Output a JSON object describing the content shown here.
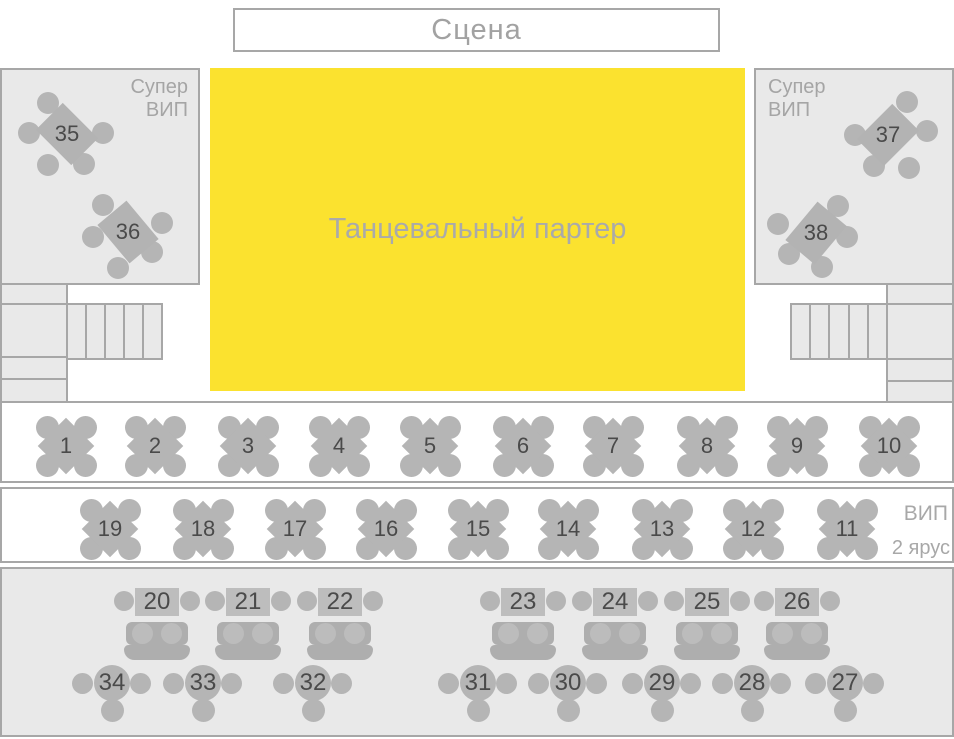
{
  "colors": {
    "dance_floor_yellow": "#fbe22f",
    "panel_fill": "#e9e9e9",
    "border_gray": "#a7a7a7",
    "table_gray": "#b5b5b5",
    "label_gray": "#a5a5a5",
    "number_dark": "#4a4a4a"
  },
  "stage": {
    "label": "Сцена"
  },
  "dance_floor": {
    "label": "Танцевальный партер"
  },
  "super_vip_left": {
    "label": "Супер\nВИП",
    "tables": [
      {
        "number": "35",
        "x": 67,
        "y": 134,
        "rot": -45,
        "chairs": [
          [
            -19,
            -31
          ],
          [
            -38,
            -1
          ],
          [
            36,
            -1
          ],
          [
            -19,
            31
          ],
          [
            17,
            30
          ]
        ]
      },
      {
        "number": "36",
        "x": 128,
        "y": 232,
        "rot": -40,
        "chairs": [
          [
            -25,
            -27
          ],
          [
            -35,
            5
          ],
          [
            34,
            -9
          ],
          [
            24,
            20
          ],
          [
            -10,
            36
          ]
        ]
      }
    ]
  },
  "super_vip_right": {
    "label": "Супер\nВИП",
    "tables": [
      {
        "number": "37",
        "x": 888,
        "y": 135,
        "rot": 45,
        "chairs": [
          [
            19,
            -33
          ],
          [
            -33,
            0
          ],
          [
            39,
            -4
          ],
          [
            -14,
            31
          ],
          [
            21,
            33
          ]
        ]
      },
      {
        "number": "38",
        "x": 816,
        "y": 233,
        "rot": 40,
        "chairs": [
          [
            22,
            -27
          ],
          [
            -38,
            -9
          ],
          [
            31,
            4
          ],
          [
            -27,
            21
          ],
          [
            6,
            34
          ]
        ]
      }
    ]
  },
  "row1": {
    "tables": [
      {
        "number": "1",
        "x": 66
      },
      {
        "number": "2",
        "x": 155
      },
      {
        "number": "3",
        "x": 248
      },
      {
        "number": "4",
        "x": 339
      },
      {
        "number": "5",
        "x": 430
      },
      {
        "number": "6",
        "x": 523
      },
      {
        "number": "7",
        "x": 613
      },
      {
        "number": "8",
        "x": 707
      },
      {
        "number": "9",
        "x": 797
      },
      {
        "number": "10",
        "x": 889
      }
    ]
  },
  "row2": {
    "label_vip": "ВИП",
    "label_tier": "2 ярус",
    "tables": [
      {
        "number": "19",
        "x": 110
      },
      {
        "number": "18",
        "x": 203
      },
      {
        "number": "17",
        "x": 295
      },
      {
        "number": "16",
        "x": 386
      },
      {
        "number": "15",
        "x": 478
      },
      {
        "number": "14",
        "x": 568
      },
      {
        "number": "13",
        "x": 662
      },
      {
        "number": "12",
        "x": 753
      },
      {
        "number": "11",
        "x": 847
      }
    ]
  },
  "bottom": {
    "sofa_tables": [
      {
        "number": "20",
        "x": 157
      },
      {
        "number": "21",
        "x": 248
      },
      {
        "number": "22",
        "x": 340
      },
      {
        "number": "23",
        "x": 523
      },
      {
        "number": "24",
        "x": 615
      },
      {
        "number": "25",
        "x": 707
      },
      {
        "number": "26",
        "x": 797
      }
    ],
    "round_tables": [
      {
        "number": "34",
        "x": 112
      },
      {
        "number": "33",
        "x": 203
      },
      {
        "number": "32",
        "x": 313
      },
      {
        "number": "31",
        "x": 478
      },
      {
        "number": "30",
        "x": 568
      },
      {
        "number": "29",
        "x": 662
      },
      {
        "number": "28",
        "x": 752
      },
      {
        "number": "27",
        "x": 845
      }
    ]
  }
}
